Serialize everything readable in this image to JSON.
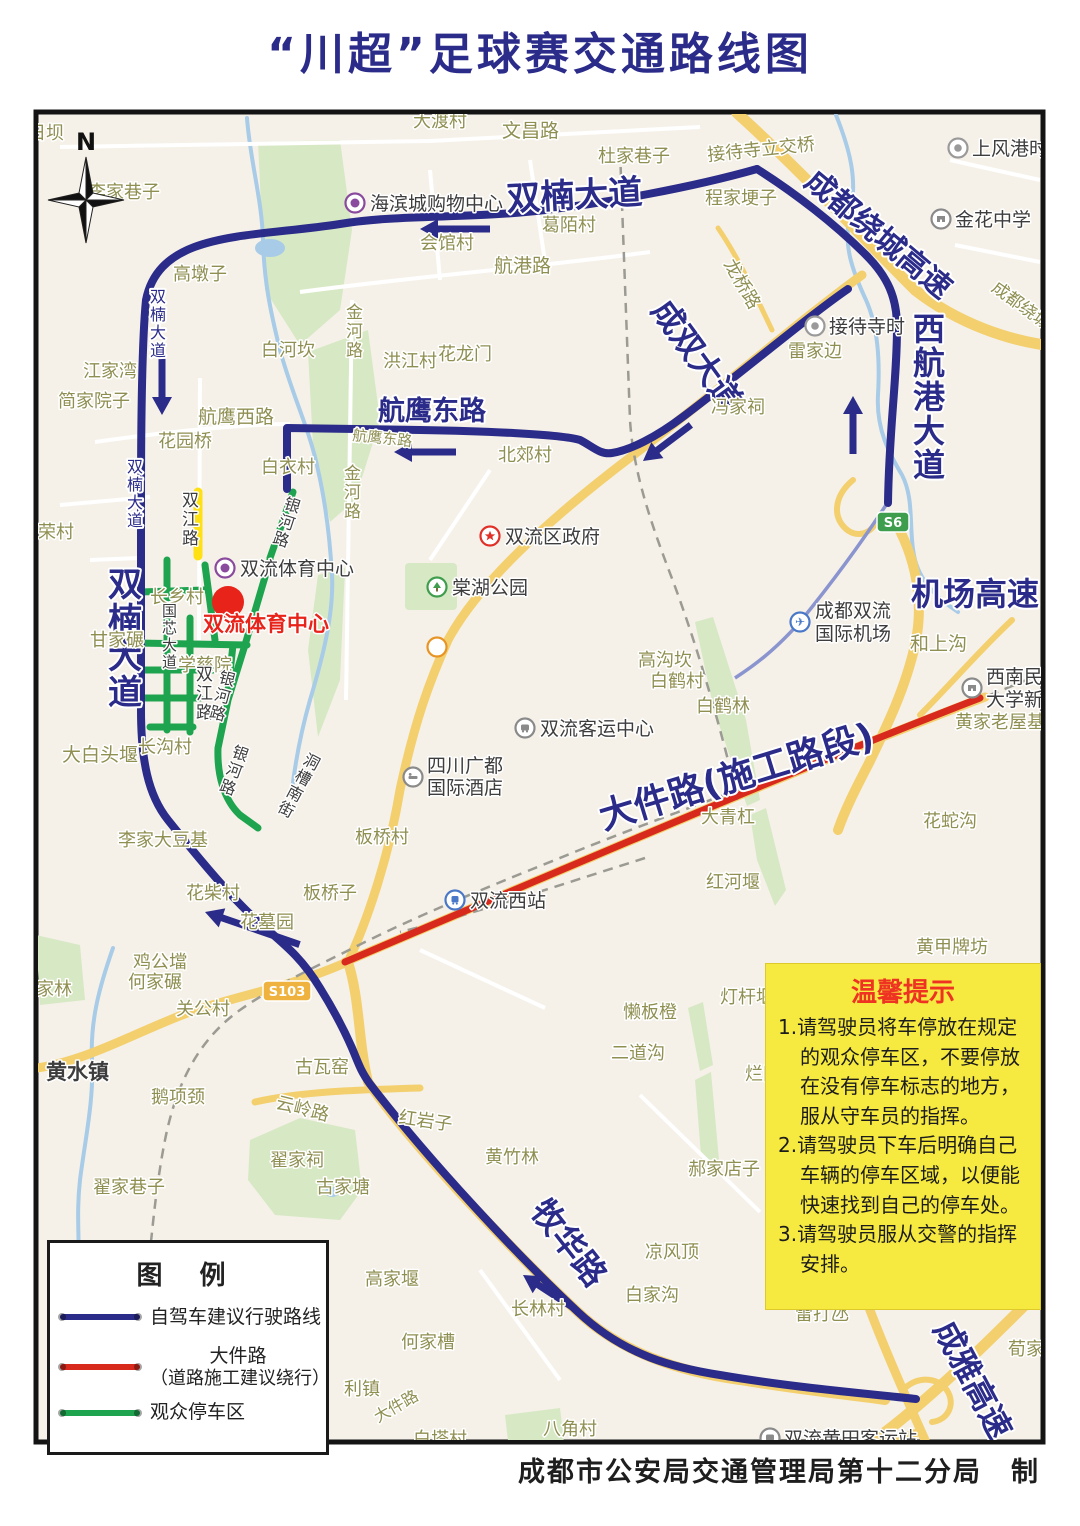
{
  "title": "“川超”足球赛交通路线图",
  "attribution": "成都市公安局交通管理局第十二分局　制",
  "compass": {
    "label": "N"
  },
  "tips": {
    "title": "温馨提示",
    "items": [
      "1.请驾驶员将车停放在规定的观众停车区，不要停放在没有停车标志的地方，服从守车员的指挥。",
      "2.请驾驶员下车后明确自己车辆的停车区域，以便能快速找到自己的停车处。",
      "3.请驾驶员服从交警的指挥安排。"
    ]
  },
  "legend": {
    "title": "图  例",
    "items": [
      {
        "label": "自驾车建议行驶路线",
        "color": "#2b2b8a"
      },
      {
        "label": "大件路",
        "label2": "（道路施工建议绕行）",
        "color": "#d8291d"
      },
      {
        "label": "观众停车区",
        "color": "#1ea34e"
      }
    ]
  },
  "map": {
    "colors": {
      "navy": "#2b2b8a",
      "olive": "#8f8f52",
      "dark": "#3d3d3d",
      "red": "#e8231a",
      "gray": "#8a8a8a",
      "route_blue": "#2b2b8a",
      "construction_red": "#d8291d",
      "parking_green": "#1ea34e",
      "closed_yellow": "#ffe013"
    },
    "stadium_marker": {
      "label": "双流体育中心"
    },
    "badges": [
      {
        "t": "S103",
        "x": 287,
        "y": 991,
        "w": 48,
        "bg": "#f0b23e"
      },
      {
        "t": "S6",
        "x": 893,
        "y": 522,
        "w": 32,
        "bg": "#3f9e4d"
      }
    ],
    "labels": [
      {
        "t": "双楠大道",
        "x": 575,
        "y": 207,
        "s": 34,
        "b": 1,
        "r": -3,
        "a": 1,
        "c": "navy"
      },
      {
        "t": "双楠大道",
        "x": 108,
        "y": 596,
        "s": 34,
        "b": 1,
        "v": 1,
        "c": "navy"
      },
      {
        "t": "双楠大道",
        "x": 150,
        "y": 302,
        "s": 16,
        "v": 1,
        "c": "navy"
      },
      {
        "t": "双楠大道",
        "x": 127,
        "y": 472,
        "s": 16,
        "v": 1,
        "c": "navy"
      },
      {
        "t": "航鹰东路",
        "x": 378,
        "y": 420,
        "s": 27,
        "b": 1,
        "c": "navy"
      },
      {
        "t": "成双大道",
        "x": 688,
        "y": 362,
        "s": 32,
        "b": 1,
        "r": 54,
        "a": 1,
        "c": "navy"
      },
      {
        "t": "成都绕城高速",
        "x": 872,
        "y": 242,
        "s": 30,
        "b": 1,
        "r": 40,
        "a": 1,
        "c": "navy"
      },
      {
        "t": "西航港大道",
        "x": 913,
        "y": 340,
        "s": 32,
        "b": 1,
        "v": 1,
        "c": "navy"
      },
      {
        "t": "机场高速",
        "x": 975,
        "y": 605,
        "s": 32,
        "b": 1,
        "a": 1,
        "c": "navy"
      },
      {
        "t": "大件路(施工路段)",
        "x": 740,
        "y": 788,
        "s": 36,
        "b": 1,
        "r": -17,
        "a": 1,
        "c": "navy"
      },
      {
        "t": "牧华路",
        "x": 560,
        "y": 1250,
        "s": 33,
        "b": 1,
        "r": 52,
        "a": 1,
        "c": "navy"
      },
      {
        "t": "成雅高速",
        "x": 963,
        "y": 1385,
        "s": 32,
        "b": 1,
        "r": 62,
        "a": 1,
        "c": "navy"
      },
      {
        "t": "双流体育中心",
        "x": 203,
        "y": 631,
        "s": 21,
        "b": 1,
        "c": "red"
      },
      {
        "t": "日坝",
        "x": 28,
        "y": 139
      },
      {
        "t": "大渡村",
        "x": 413,
        "y": 127
      },
      {
        "t": "文昌路",
        "x": 502,
        "y": 137,
        "s": 19
      },
      {
        "t": "杜家巷子",
        "x": 598,
        "y": 162
      },
      {
        "t": "李家巷子",
        "x": 88,
        "y": 198
      },
      {
        "t": "接待寺立交桥",
        "x": 708,
        "y": 161,
        "r": -6
      },
      {
        "t": "程家埂子",
        "x": 705,
        "y": 204
      },
      {
        "t": "葛陌村",
        "x": 542,
        "y": 231
      },
      {
        "t": "会馆村",
        "x": 420,
        "y": 249
      },
      {
        "t": "航港路",
        "x": 494,
        "y": 272,
        "s": 19
      },
      {
        "t": "高墩子",
        "x": 173,
        "y": 280
      },
      {
        "t": "龙桥路",
        "x": 737,
        "y": 287,
        "r": 60,
        "a": 1
      },
      {
        "t": "雷家边",
        "x": 788,
        "y": 357
      },
      {
        "t": "白河坎",
        "x": 261,
        "y": 356
      },
      {
        "t": "金河路",
        "x": 346,
        "y": 318,
        "v": 1,
        "s": 17
      },
      {
        "t": "洪江村",
        "x": 383,
        "y": 367
      },
      {
        "t": "花龙门",
        "x": 438,
        "y": 360
      },
      {
        "t": "江家湾",
        "x": 83,
        "y": 377
      },
      {
        "t": "简家院子",
        "x": 58,
        "y": 407
      },
      {
        "t": "航鹰西路",
        "x": 198,
        "y": 423,
        "s": 19
      },
      {
        "t": "航鹰东路",
        "x": 352,
        "y": 440,
        "s": 15,
        "r": 6
      },
      {
        "t": "花园桥",
        "x": 158,
        "y": 447
      },
      {
        "t": "北郊村",
        "x": 498,
        "y": 461
      },
      {
        "t": "白衣村",
        "x": 261,
        "y": 473
      },
      {
        "t": "冯家祠",
        "x": 711,
        "y": 413
      },
      {
        "t": "金河路",
        "x": 344,
        "y": 479,
        "v": 1,
        "s": 17
      },
      {
        "t": "荣村",
        "x": 38,
        "y": 538
      },
      {
        "t": "长乡村",
        "x": 150,
        "y": 603
      },
      {
        "t": "甘家碾",
        "x": 90,
        "y": 646
      },
      {
        "t": "学慈院",
        "x": 178,
        "y": 671
      },
      {
        "t": "高沟坎",
        "x": 638,
        "y": 666
      },
      {
        "t": "白鹤村",
        "x": 650,
        "y": 687
      },
      {
        "t": "白鹤林",
        "x": 696,
        "y": 712
      },
      {
        "t": "和上沟",
        "x": 910,
        "y": 650,
        "s": 19
      },
      {
        "t": "黄家老屋基",
        "x": 955,
        "y": 728
      },
      {
        "t": "大青杠",
        "x": 701,
        "y": 823
      },
      {
        "t": "花蛇沟",
        "x": 923,
        "y": 827
      },
      {
        "t": "大白头堰",
        "x": 62,
        "y": 761,
        "s": 19
      },
      {
        "t": "长沟村",
        "x": 138,
        "y": 753
      },
      {
        "t": "李家大豆基",
        "x": 118,
        "y": 846
      },
      {
        "t": "板桥村",
        "x": 355,
        "y": 843
      },
      {
        "t": "板桥子",
        "x": 303,
        "y": 899
      },
      {
        "t": "红河堰",
        "x": 706,
        "y": 888
      },
      {
        "t": "花柴村",
        "x": 186,
        "y": 899
      },
      {
        "t": "花墓园",
        "x": 240,
        "y": 928
      },
      {
        "t": "黄甲牌坊",
        "x": 916,
        "y": 953
      },
      {
        "t": "鸡公壋",
        "x": 133,
        "y": 968
      },
      {
        "t": "何家碾",
        "x": 128,
        "y": 988
      },
      {
        "t": "宋家林",
        "x": 18,
        "y": 995
      },
      {
        "t": "关公村",
        "x": 176,
        "y": 1015
      },
      {
        "t": "懒板橙",
        "x": 623,
        "y": 1018
      },
      {
        "t": "灯杆堰",
        "x": 720,
        "y": 1003
      },
      {
        "t": "烂田",
        "x": 745,
        "y": 1080
      },
      {
        "t": "二道沟",
        "x": 611,
        "y": 1059
      },
      {
        "t": "古瓦窑",
        "x": 295,
        "y": 1073
      },
      {
        "t": "云岭路",
        "x": 275,
        "y": 1108,
        "r": 14
      },
      {
        "t": "鹅项颈",
        "x": 151,
        "y": 1103
      },
      {
        "t": "红岩子",
        "x": 398,
        "y": 1123,
        "r": 8
      },
      {
        "t": "翟家祠",
        "x": 270,
        "y": 1166
      },
      {
        "t": "古家塘",
        "x": 316,
        "y": 1193
      },
      {
        "t": "翟家巷子",
        "x": 93,
        "y": 1193
      },
      {
        "t": "黄竹林",
        "x": 485,
        "y": 1163
      },
      {
        "t": "郝家店子",
        "x": 688,
        "y": 1175
      },
      {
        "t": "凉风顶",
        "x": 645,
        "y": 1258
      },
      {
        "t": "白家沟",
        "x": 625,
        "y": 1301
      },
      {
        "t": "高家堰",
        "x": 365,
        "y": 1285
      },
      {
        "t": "长林村",
        "x": 511,
        "y": 1315
      },
      {
        "t": "何家槽",
        "x": 401,
        "y": 1348
      },
      {
        "t": "利镇",
        "x": 344,
        "y": 1395
      },
      {
        "t": "大件路",
        "x": 378,
        "y": 1423,
        "r": -30,
        "s": 16
      },
      {
        "t": "白塔村",
        "x": 413,
        "y": 1445
      },
      {
        "t": "八角村",
        "x": 543,
        "y": 1435
      },
      {
        "t": "雷打氹",
        "x": 795,
        "y": 1320
      },
      {
        "t": "荀家",
        "x": 1008,
        "y": 1355
      },
      {
        "t": "成都绕城",
        "x": 1018,
        "y": 310,
        "r": 36,
        "a": 1,
        "s": 17
      },
      {
        "t": "黄水镇",
        "x": 46,
        "y": 1079,
        "s": 21,
        "c": "dark",
        "b": 1
      },
      {
        "t": "双江路",
        "x": 182,
        "y": 506,
        "v": 1,
        "c": "dark",
        "s": 17
      },
      {
        "t": "双江路",
        "x": 196,
        "y": 680,
        "v": 1,
        "c": "dark",
        "s": 17
      },
      {
        "t": "国芯大道",
        "x": 162,
        "y": 616,
        "v": 1,
        "c": "dark",
        "s": 15
      },
      {
        "t": "银河路",
        "x": 283,
        "y": 508,
        "v": 1,
        "c": "dark",
        "s": 16,
        "r": 18
      },
      {
        "t": "银河路",
        "x": 218,
        "y": 682,
        "v": 1,
        "c": "dark",
        "s": 16,
        "r": 15
      },
      {
        "t": "银河路",
        "x": 231,
        "y": 756,
        "v": 1,
        "c": "dark",
        "s": 16,
        "r": 20
      },
      {
        "t": "洞槽南街",
        "x": 302,
        "y": 763,
        "v": 1,
        "c": "dark",
        "s": 16,
        "r": 28
      }
    ],
    "pois": [
      {
        "type": "mall",
        "x": 355,
        "y": 203,
        "label": "海滨城购物中心",
        "lx": 370,
        "ly": 210
      },
      {
        "type": "stadium",
        "x": 225,
        "y": 568,
        "label": "双流体育中心",
        "lx": 240,
        "ly": 575
      },
      {
        "type": "gov",
        "x": 490,
        "y": 536,
        "label": "双流区政府",
        "lx": 505,
        "ly": 543
      },
      {
        "type": "park",
        "x": 437,
        "y": 587,
        "label": "棠湖公园",
        "lx": 452,
        "ly": 594
      },
      {
        "type": "hotelO",
        "x": 437,
        "y": 647
      },
      {
        "type": "bus",
        "x": 525,
        "y": 728,
        "label": "双流客运中心",
        "lx": 540,
        "ly": 735
      },
      {
        "type": "hotel",
        "x": 413,
        "y": 777,
        "label": "四川广都",
        "label2": "国际酒店",
        "lx": 427,
        "ly": 772,
        "ly2": 794
      },
      {
        "type": "train",
        "x": 455,
        "y": 900,
        "label": "双流西站",
        "lx": 470,
        "ly": 907
      },
      {
        "type": "airport",
        "x": 800,
        "y": 622,
        "label": "成都双流",
        "label2": "国际机场",
        "lx": 815,
        "ly": 617,
        "ly2": 640
      },
      {
        "type": "school",
        "x": 941,
        "y": 219,
        "label": "金花中学",
        "lx": 955,
        "ly": 226
      },
      {
        "type": "station",
        "x": 958,
        "y": 148,
        "label": "上风港时",
        "lx": 972,
        "ly": 155
      },
      {
        "type": "station",
        "x": 815,
        "y": 326,
        "label": "接待寺时",
        "lx": 829,
        "ly": 333
      },
      {
        "type": "school",
        "x": 972,
        "y": 688,
        "label": "西南民",
        "label2": "大学新",
        "lx": 986,
        "ly": 683,
        "ly2": 706
      },
      {
        "type": "bus",
        "x": 770,
        "y": 1438,
        "label": "双流黄田客运站",
        "lx": 784,
        "ly": 1445
      }
    ]
  }
}
